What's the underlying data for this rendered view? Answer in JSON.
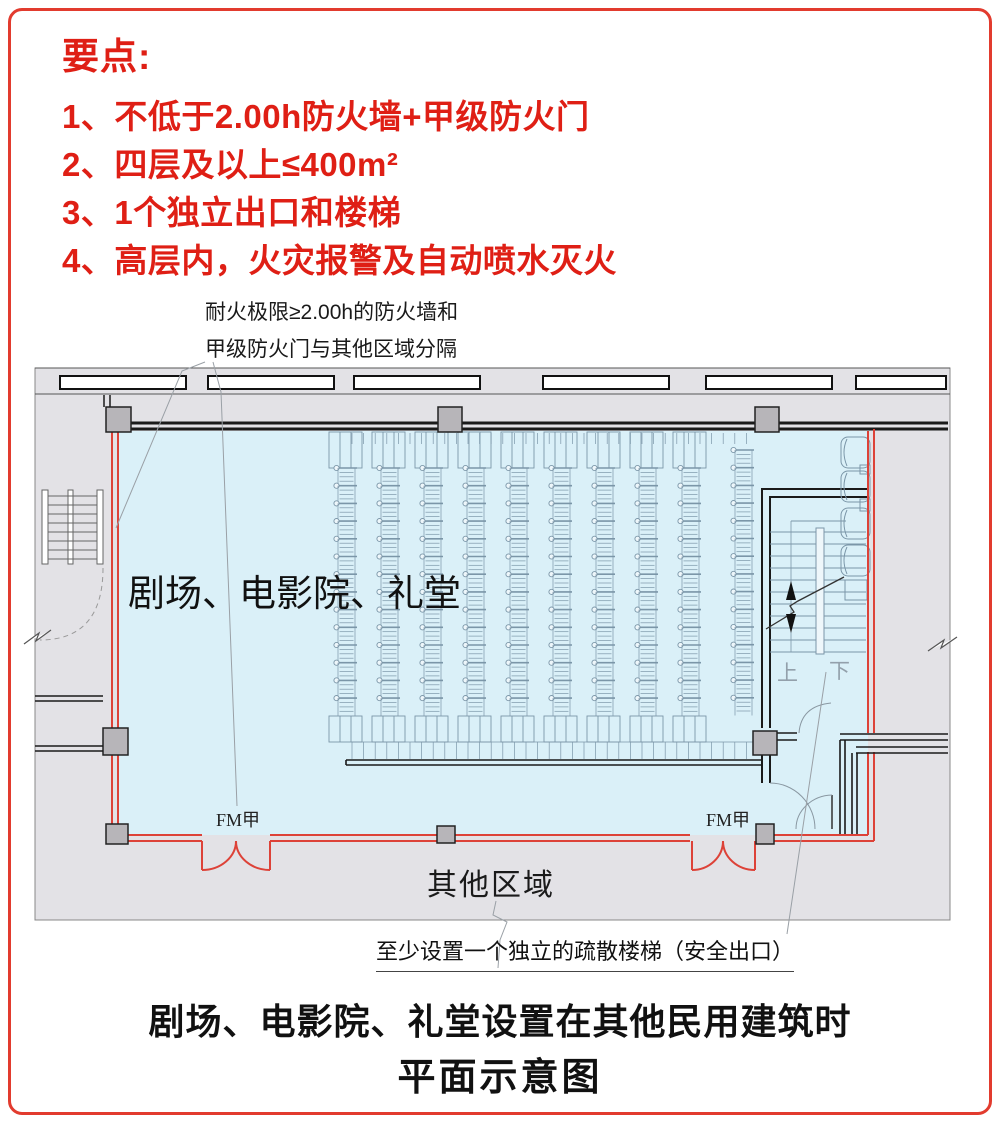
{
  "notes": {
    "heading": "要点:",
    "items": [
      "1、不低于2.00h防火墙+甲级防火门",
      "2、四层及以上≤400m²",
      "3、1个独立出口和楼梯",
      "4、高层内，火灾报警及自动喷水灭火"
    ]
  },
  "plan": {
    "annotation_top_line1": "耐火极限≥2.00h的防火墙和",
    "annotation_top_line2": "甲级防火门与其他区域分隔",
    "room_label": "剧场、电影院、礼堂",
    "other_area_label": "其他区域",
    "door_label_left": "FM甲",
    "door_label_right": "FM甲",
    "stair_up_label": "上",
    "stair_down_label": "下",
    "annotation_bottom": "至少设置一个独立的疏散楼梯（安全出口）"
  },
  "caption": {
    "line1": "剧场、电影院、礼堂设置在其他民用建筑时",
    "line2": "平面示意图"
  },
  "colors": {
    "red_accent": "#df1f15",
    "red_wall": "#dd4238",
    "red_border": "#e23b2e",
    "room_fill": "#daf0f8",
    "floor_fill": "#e3e2e6",
    "wall_dark": "#1a1a1a",
    "seat_line": "#7b96a8",
    "column_fill": "#b7b5b9"
  }
}
